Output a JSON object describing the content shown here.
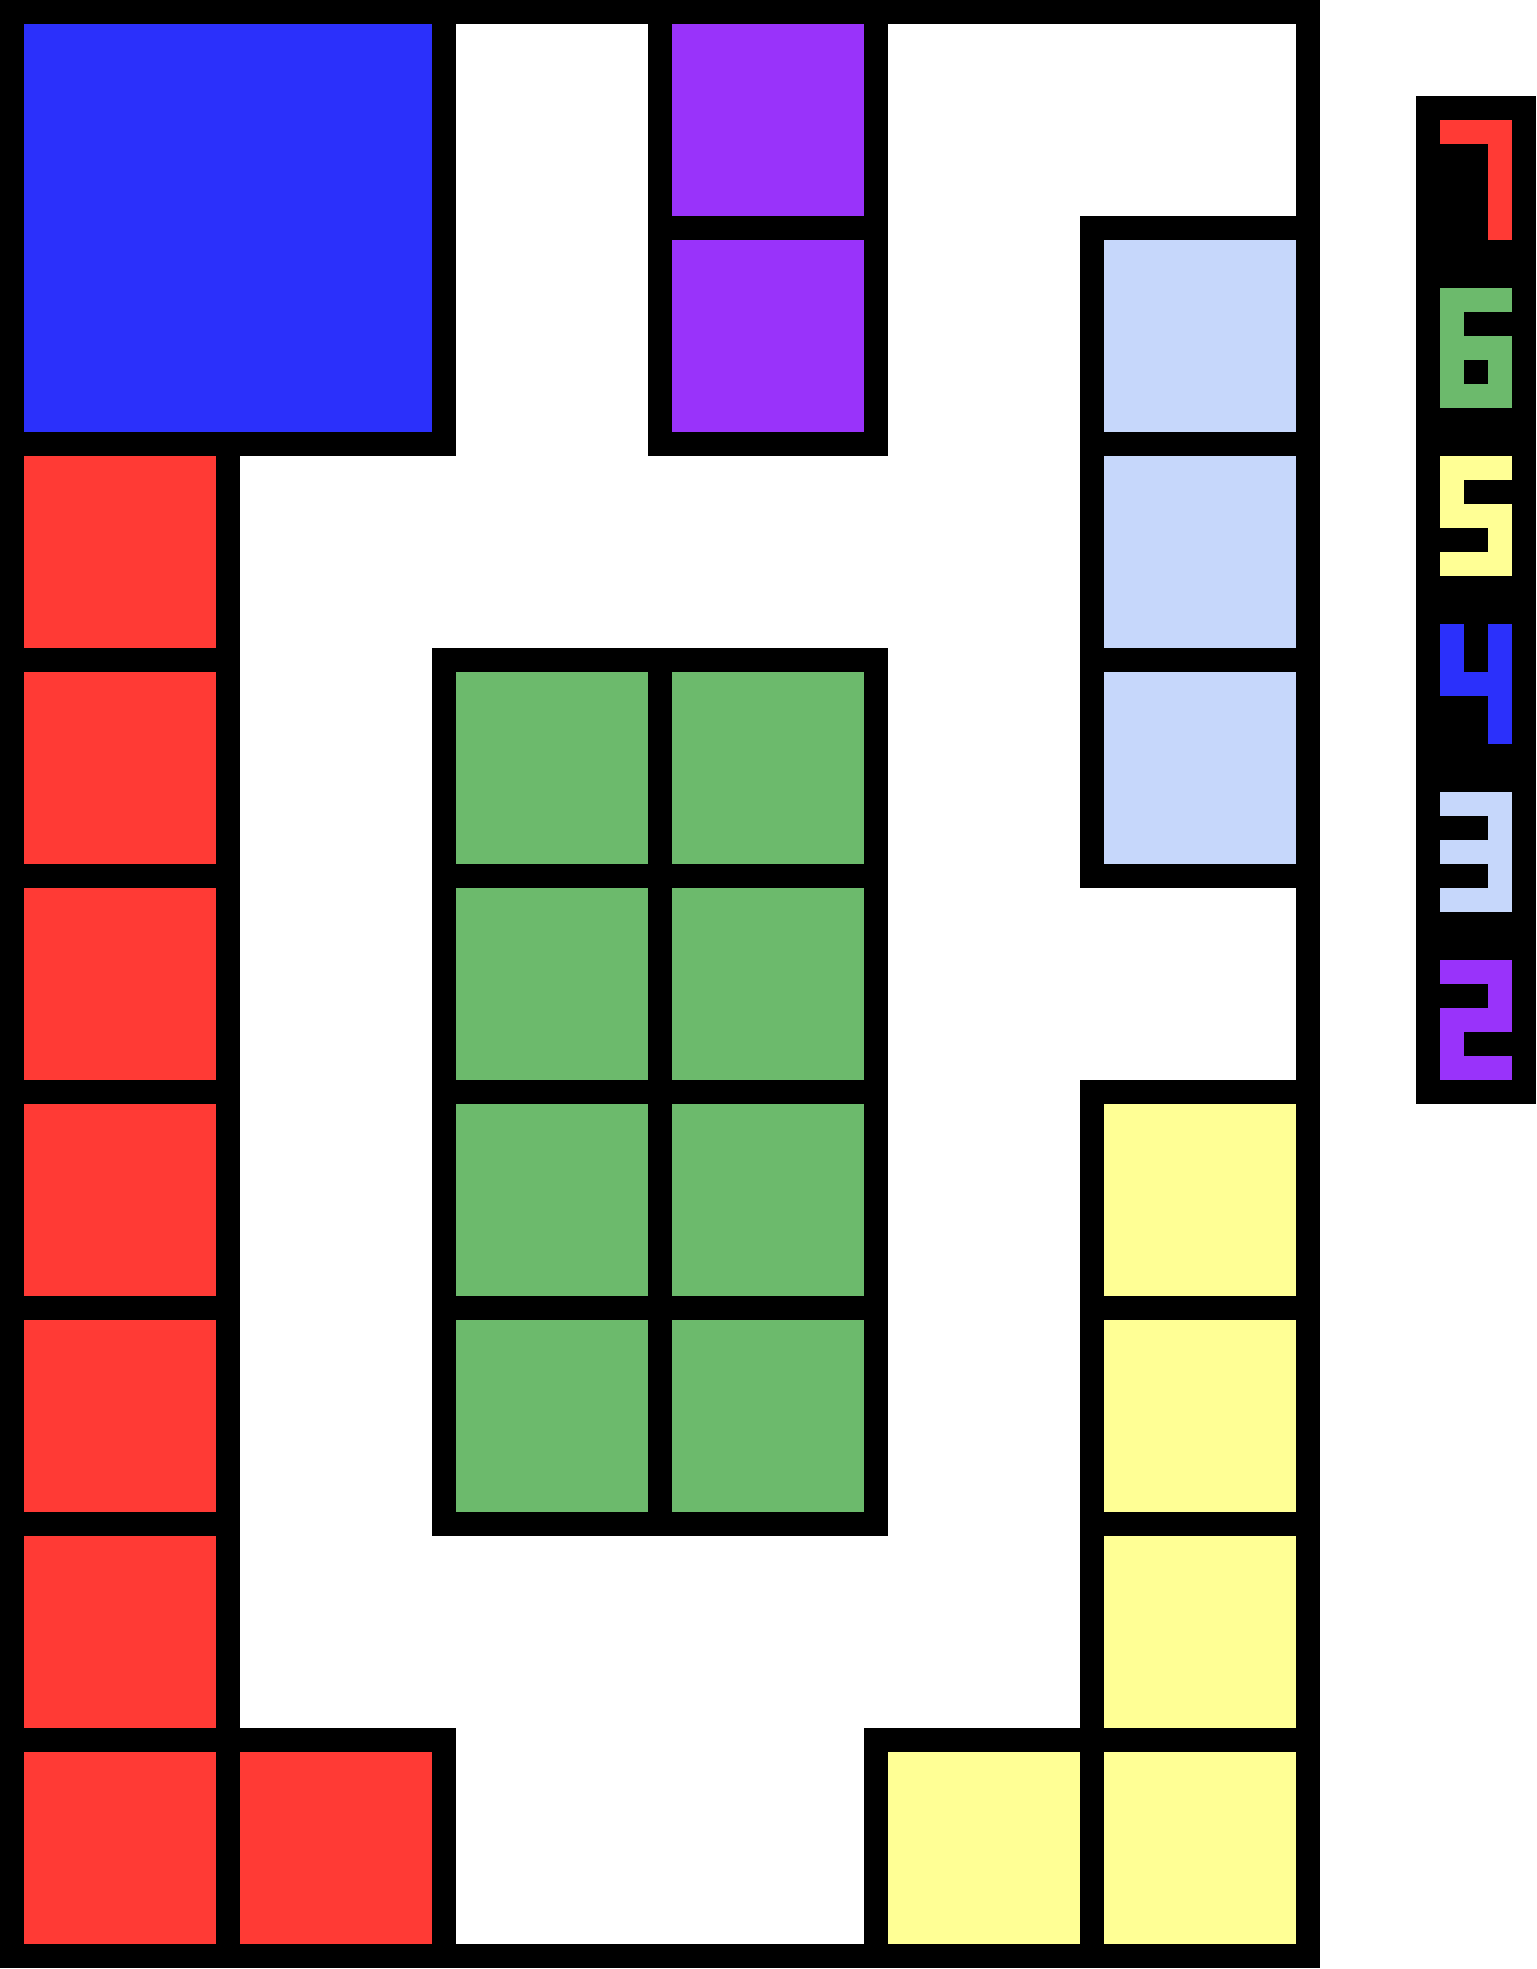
{
  "palette": {
    "background": "#FFFFFF",
    "stroke": "#000000",
    "red": "#FF3A35",
    "green": "#6CBA6C",
    "yellow": "#FFFF95",
    "blue": "#2B30FB",
    "lightblue": "#C6D7FB",
    "purple": "#9933FA"
  },
  "board": {
    "columns": 6,
    "rows": 9,
    "cell_size_px": 216,
    "stroke_px": 24,
    "width_px": 1320,
    "height_px": 1968,
    "pieces": [
      {
        "id": "blue-square",
        "color": "blue",
        "col": 0,
        "row": 0,
        "col_span": 2,
        "row_span": 2
      },
      {
        "id": "purple-tile-1",
        "color": "purple",
        "col": 3,
        "row": 0,
        "col_span": 1,
        "row_span": 1
      },
      {
        "id": "purple-tile-2",
        "color": "purple",
        "col": 3,
        "row": 1,
        "col_span": 1,
        "row_span": 1
      },
      {
        "id": "lightblue-tile-1",
        "color": "lightblue",
        "col": 5,
        "row": 1,
        "col_span": 1,
        "row_span": 1
      },
      {
        "id": "lightblue-tile-2",
        "color": "lightblue",
        "col": 5,
        "row": 2,
        "col_span": 1,
        "row_span": 1
      },
      {
        "id": "lightblue-tile-3",
        "color": "lightblue",
        "col": 5,
        "row": 3,
        "col_span": 1,
        "row_span": 1
      },
      {
        "id": "red-tile-1",
        "color": "red",
        "col": 0,
        "row": 2,
        "col_span": 1,
        "row_span": 1
      },
      {
        "id": "red-tile-2",
        "color": "red",
        "col": 0,
        "row": 3,
        "col_span": 1,
        "row_span": 1
      },
      {
        "id": "red-tile-3",
        "color": "red",
        "col": 0,
        "row": 4,
        "col_span": 1,
        "row_span": 1
      },
      {
        "id": "red-tile-4",
        "color": "red",
        "col": 0,
        "row": 5,
        "col_span": 1,
        "row_span": 1
      },
      {
        "id": "red-tile-5",
        "color": "red",
        "col": 0,
        "row": 6,
        "col_span": 1,
        "row_span": 1
      },
      {
        "id": "red-tile-6",
        "color": "red",
        "col": 0,
        "row": 7,
        "col_span": 1,
        "row_span": 1
      },
      {
        "id": "red-tile-7",
        "color": "red",
        "col": 0,
        "row": 8,
        "col_span": 1,
        "row_span": 1
      },
      {
        "id": "red-tile-8",
        "color": "red",
        "col": 1,
        "row": 8,
        "col_span": 1,
        "row_span": 1
      },
      {
        "id": "green-tile-1",
        "color": "green",
        "col": 2,
        "row": 3,
        "col_span": 1,
        "row_span": 1
      },
      {
        "id": "green-tile-2",
        "color": "green",
        "col": 3,
        "row": 3,
        "col_span": 1,
        "row_span": 1
      },
      {
        "id": "green-tile-3",
        "color": "green",
        "col": 2,
        "row": 4,
        "col_span": 1,
        "row_span": 1
      },
      {
        "id": "green-tile-4",
        "color": "green",
        "col": 3,
        "row": 4,
        "col_span": 1,
        "row_span": 1
      },
      {
        "id": "green-tile-5",
        "color": "green",
        "col": 2,
        "row": 5,
        "col_span": 1,
        "row_span": 1
      },
      {
        "id": "green-tile-6",
        "color": "green",
        "col": 3,
        "row": 5,
        "col_span": 1,
        "row_span": 1
      },
      {
        "id": "green-tile-7",
        "color": "green",
        "col": 2,
        "row": 6,
        "col_span": 1,
        "row_span": 1
      },
      {
        "id": "green-tile-8",
        "color": "green",
        "col": 3,
        "row": 6,
        "col_span": 1,
        "row_span": 1
      },
      {
        "id": "yellow-tile-1",
        "color": "yellow",
        "col": 5,
        "row": 5,
        "col_span": 1,
        "row_span": 1
      },
      {
        "id": "yellow-tile-2",
        "color": "yellow",
        "col": 5,
        "row": 6,
        "col_span": 1,
        "row_span": 1
      },
      {
        "id": "yellow-tile-3",
        "color": "yellow",
        "col": 5,
        "row": 7,
        "col_span": 1,
        "row_span": 1
      },
      {
        "id": "yellow-tile-4",
        "color": "yellow",
        "col": 5,
        "row": 8,
        "col_span": 1,
        "row_span": 1
      },
      {
        "id": "yellow-tile-5",
        "color": "yellow",
        "col": 4,
        "row": 8,
        "col_span": 1,
        "row_span": 1
      }
    ]
  },
  "legend": {
    "x_px": 1416,
    "y_px": 96,
    "width_px": 120,
    "height_px": 1008,
    "pad_px": 24,
    "digit_width_px": 72,
    "digit_height_px": 120,
    "gap_px": 48,
    "entries": [
      {
        "digit": "7",
        "color": "red"
      },
      {
        "digit": "6",
        "color": "green"
      },
      {
        "digit": "5",
        "color": "yellow"
      },
      {
        "digit": "4",
        "color": "blue"
      },
      {
        "digit": "3",
        "color": "lightblue"
      },
      {
        "digit": "2",
        "color": "purple"
      }
    ],
    "digit_glyphs": {
      "7": [
        [
          0,
          0,
          3,
          1
        ],
        [
          2,
          0,
          1,
          5
        ]
      ],
      "6": [
        [
          0,
          0,
          3,
          1
        ],
        [
          0,
          0,
          1,
          5
        ],
        [
          0,
          2,
          3,
          1
        ],
        [
          2,
          2,
          1,
          3
        ],
        [
          0,
          4,
          3,
          1
        ]
      ],
      "5": [
        [
          0,
          0,
          3,
          1
        ],
        [
          0,
          0,
          1,
          3
        ],
        [
          0,
          2,
          3,
          1
        ],
        [
          2,
          2,
          1,
          3
        ],
        [
          0,
          4,
          3,
          1
        ]
      ],
      "4": [
        [
          0,
          0,
          1,
          3
        ],
        [
          2,
          0,
          1,
          5
        ],
        [
          0,
          2,
          3,
          1
        ]
      ],
      "3": [
        [
          0,
          0,
          3,
          1
        ],
        [
          0,
          2,
          3,
          1
        ],
        [
          0,
          4,
          3,
          1
        ],
        [
          2,
          0,
          1,
          5
        ]
      ],
      "2": [
        [
          0,
          0,
          3,
          1
        ],
        [
          2,
          0,
          1,
          3
        ],
        [
          0,
          2,
          3,
          1
        ],
        [
          0,
          2,
          1,
          3
        ],
        [
          0,
          4,
          3,
          1
        ]
      ]
    }
  }
}
